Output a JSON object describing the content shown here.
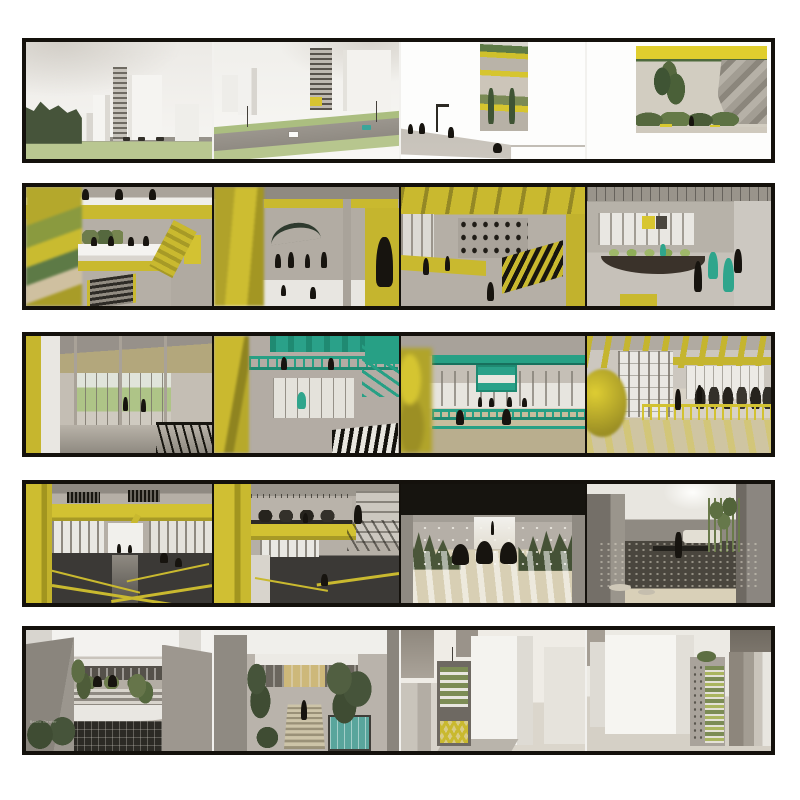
{
  "board": {
    "description": "Architecture presentation board: five horizontal black-framed strips of rendered perspective views",
    "frame_color": "#14110c",
    "background_color": "#ffffff",
    "palette": {
      "accent_yellow": "#c9b92f",
      "accent_teal": "#27a085",
      "lawn_green": "#b7c68e",
      "foliage_green": "#46543a",
      "concrete_gray": "#b3aca4",
      "silhouette_black": "#17140f",
      "floor_beige": "#d8cfb4"
    }
  },
  "watermark": {
    "text": "Bravo Center"
  },
  "strips": [
    {
      "label": "urban exterior street views",
      "panels": [
        {
          "description": "Street view with white towers, dark trees at left, lawn and road with cars"
        },
        {
          "description": "Boulevard view with highway, green medians, gridded tower with yellow base notch, white slabs"
        },
        {
          "description": "White street-level vignette with sidewalk, pedestrians, lamp post, cyclist and recessed yellow-green building slice"
        },
        {
          "description": "Courtyard vignette with yellow ceiling band, trees, planting and gray faceted climbing wall"
        }
      ]
    },
    {
      "label": "yellow atrium interiors",
      "panels": [
        {
          "description": "Yellow atrium with stained-glass wall, white footbridge with figures, escalator and yellow door"
        },
        {
          "description": "Corridor overlook framed by blurred yellow fins, concrete facade, canopy and figures"
        },
        {
          "description": "Bike hub interior with yellow ceiling beams, wall of bikes and black-yellow striped railing"
        },
        {
          "description": "Gray atrium lounge with window wall, yellow sign, green seating, curved balcony and teal-jacketed figures"
        }
      ]
    },
    {
      "label": "sports hall interiors with teal accents",
      "panels": [
        {
          "description": "Glass-walled gallery with yellow column edge, tan ceiling and green landscape beyond"
        },
        {
          "description": "Atrium with teal balcony railings, teal ceiling boxes and striped guardrail"
        },
        {
          "description": "Basketball court with teal beams and backboard, bright windows and seated figures"
        },
        {
          "description": "Fitness hall with yellow roof beams, yellow railing, exercise equipment and striped daylight floor"
        }
      ]
    },
    {
      "label": "running track and quiet spaces",
      "panels": [
        {
          "description": "Indoor running track with yellow beam band, vents, windows and dark track with yellow lanes"
        },
        {
          "description": "Second track view with yellow column, upper equipment balcony and window wall"
        },
        {
          "description": "Meditation room with dark ceiling, grasses, seated silhouettes and striped tatami floor"
        },
        {
          "description": "Zen gravel courtyard with gray walls, bamboo, stepping stones and single figure"
        }
      ]
    },
    {
      "label": "courtyard terraces and white city aerials",
      "panels": [
        {
          "description": "Sunken courtyard with terraced planted building, striped terraces and dark glazed lower level"
        },
        {
          "description": "Courtyard with glass pavilion, trees, descending stairs and teal swimming pool"
        },
        {
          "description": "White aerial city view with sectioned building showing green terraces and yellow lattice"
        },
        {
          "description": "White aerial city view with large slab and building slice of stacked green terraces"
        }
      ]
    }
  ]
}
